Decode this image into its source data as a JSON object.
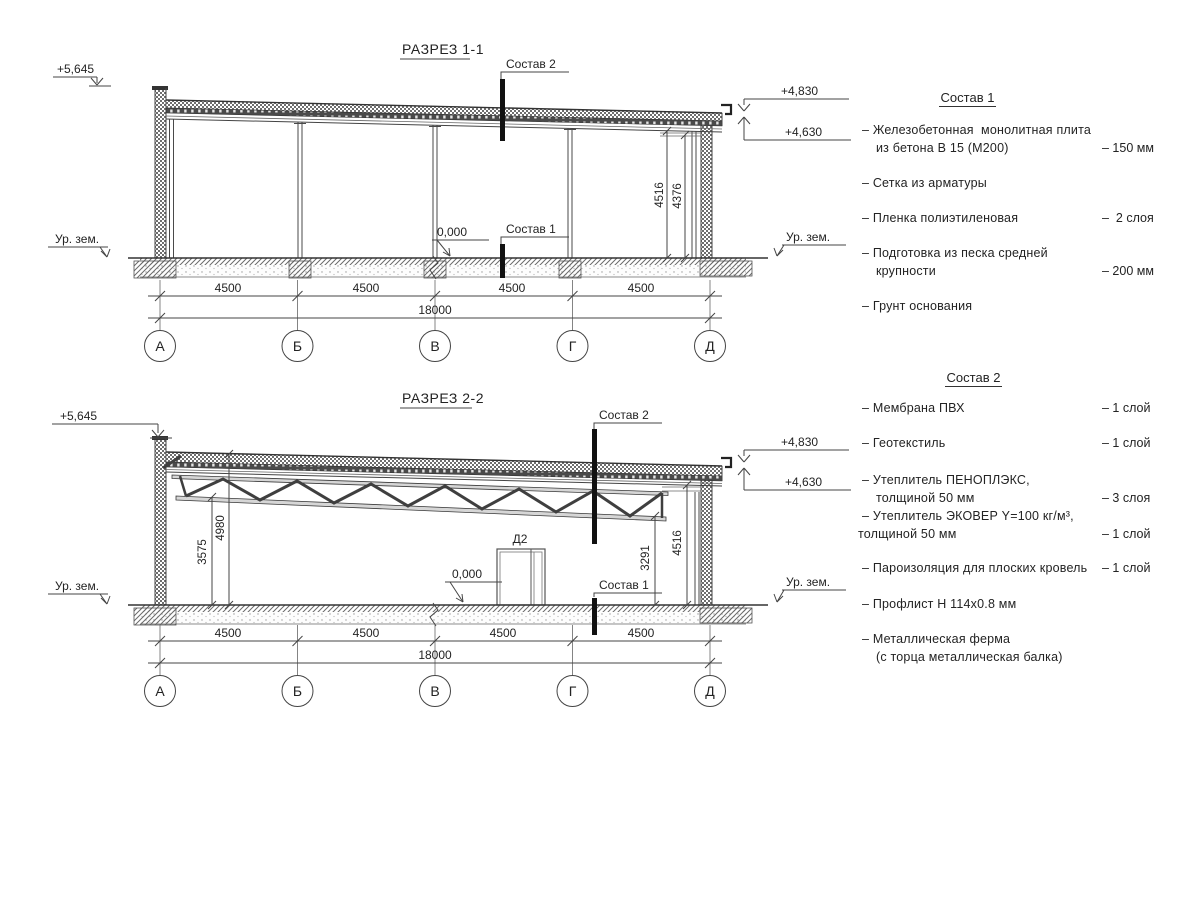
{
  "drawing": {
    "s1": {
      "title": "РАЗРЕЗ 1-1",
      "elev_left": "+5,645",
      "elev_right_top": "+4,830",
      "elev_right_bot": "+4,630",
      "ground_left": "Ур. зем.",
      "ground_right": "Ур. зем.",
      "zero": "0,000",
      "marker1": "Состав 1",
      "marker2": "Состав 2",
      "dim_v1": "4516",
      "dim_v2": "4376",
      "bays": [
        "4500",
        "4500",
        "4500",
        "4500"
      ],
      "total": "18000",
      "axes": [
        "А",
        "Б",
        "В",
        "Г",
        "Д"
      ]
    },
    "s2": {
      "title": "РАЗРЕЗ 2-2",
      "elev_left": "+5,645",
      "elev_right_top": "+4,830",
      "elev_right_bot": "+4,630",
      "ground_left": "Ур. зем.",
      "ground_right": "Ур. зем.",
      "zero": "0,000",
      "marker1": "Состав 1",
      "marker2": "Состав 2",
      "door": "Д2",
      "dim_truss_left": "3575",
      "dim_roof_left": "4980",
      "dim_truss_right": "3291",
      "dim_v_right": "4516",
      "bays": [
        "4500",
        "4500",
        "4500",
        "4500"
      ],
      "total": "18000",
      "axes": [
        "А",
        "Б",
        "В",
        "Г",
        "Д"
      ]
    }
  },
  "notes1": {
    "heading": "Состав 1",
    "items": [
      {
        "l1": "– Железобетонная  монолитная плита",
        "l2": "из бетона В 15 (М200)",
        "val": "– 150 мм"
      },
      {
        "l1": "– Сетка из арматуры",
        "l2": "",
        "val": ""
      },
      {
        "l1": "– Пленка полиэтиленовая",
        "l2": "",
        "val": "–  2 слоя"
      },
      {
        "l1": "– Подготовка из песка средней",
        "l2": "крупности",
        "val": "– 200 мм"
      },
      {
        "l1": "– Грунт основания",
        "l2": "",
        "val": ""
      }
    ]
  },
  "notes2": {
    "heading": "Состав 2",
    "items": [
      {
        "l1": "– Мембрана ПВХ",
        "l2": "",
        "val": "– 1 слой"
      },
      {
        "l1": "– Геотекстиль",
        "l2": "",
        "val": "– 1 слой"
      },
      {
        "l1": "– Утеплитель ПЕНОПЛЭКС,",
        "l2": "толщиной 50 мм",
        "val": "– 3 слоя"
      },
      {
        "l1": "– Утеплитель ЭКОВЕР Y=100 кг/м³,",
        "l2": "толщиной 50 мм",
        "val": "– 1 слой"
      },
      {
        "l1": "– Пароизоляция для плоских кровель",
        "l2": "",
        "val": "– 1 слой"
      },
      {
        "l1": "– Профлист Н 114х0.8 мм",
        "l2": "",
        "val": ""
      },
      {
        "l1": "– Металлическая ферма",
        "l2": "(с торца металлическая балка)",
        "val": ""
      }
    ]
  },
  "colors": {
    "line": "#444444",
    "text": "#232323",
    "marker": "#111111"
  }
}
